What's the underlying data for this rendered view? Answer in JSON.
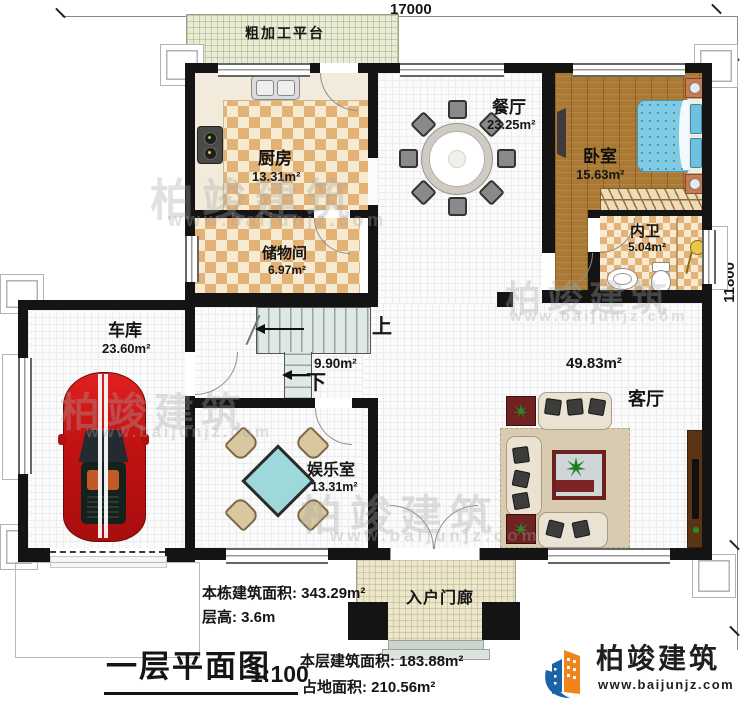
{
  "plan": {
    "dimensions": {
      "top": "17000",
      "right_upper": "11800",
      "right_lower": "1800"
    },
    "rooms": {
      "platform": {
        "name": "粗加工平台"
      },
      "kitchen": {
        "name": "厨房",
        "area": "13.31m²"
      },
      "dining": {
        "name": "餐厅",
        "area": "23.25m²"
      },
      "bedroom": {
        "name": "卧室",
        "area": "15.63m²"
      },
      "ensuite": {
        "name": "内卫",
        "area": "5.04m²"
      },
      "storage": {
        "name": "储物间",
        "area": "6.97m²"
      },
      "garage": {
        "name": "车库",
        "area": "23.60m²"
      },
      "entertainment": {
        "name": "娱乐室",
        "area": "13.31m²"
      },
      "living": {
        "name": "客厅",
        "area": "49.83m²"
      },
      "porch": {
        "name": "入户门廊"
      },
      "stairs": {
        "area": "9.90m²",
        "up_label": "上",
        "down_label": "下"
      }
    },
    "title_block": {
      "building_total_area": "本栋建筑面积: 343.29m²",
      "floor_height": "层高: 3.6m",
      "plan_name": "一层平面图",
      "scale": "1:100",
      "floor_area": "本层建筑面积: 183.88m²",
      "footprint_area": "占地面积: 210.56m²"
    },
    "brand": {
      "logo_text": "柏竣建筑",
      "website": "www.baijunjz.com"
    },
    "watermark": {
      "text": "柏竣建筑",
      "url": "www.baijunjz.com"
    },
    "colors": {
      "wall": "#141414",
      "checker": "#e3b277",
      "wood": "#aa7a35",
      "bed": "#7ecbe3",
      "car": "#cc1414",
      "brand_blue": "#1b63a8",
      "brand_orange": "#f08418"
    }
  }
}
